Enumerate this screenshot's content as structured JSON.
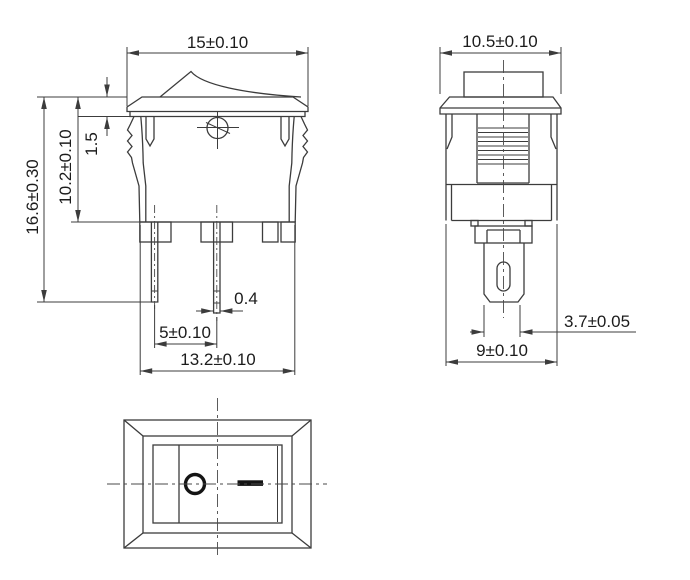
{
  "drawing": {
    "front_view": {
      "flange_width": "15±0.10",
      "overall_height": "16.6±0.30",
      "body_height": "10.2±0.10",
      "flange_thickness": "1.5",
      "terminal_thickness": "0.4",
      "terminal_spacing": "5±0.10",
      "body_width": "13.2±0.10"
    },
    "side_view": {
      "flange_depth": "10.5±0.10",
      "terminal_post_width": "3.7±0.05",
      "body_depth": "9±0.10"
    },
    "bottom_view": {
      "off_icon": "circle-ring",
      "on_icon": "solid-bar"
    }
  }
}
